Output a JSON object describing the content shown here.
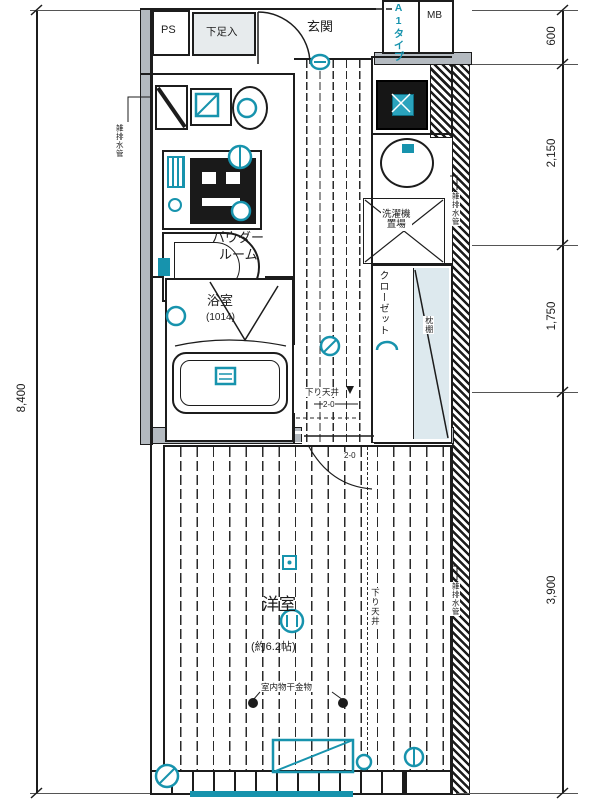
{
  "plan_type": "A1タイプ",
  "labels": {
    "ps": "PS",
    "mb": "MB",
    "shoe_cabinet": "下足入",
    "entrance": "玄関",
    "powder_room_line1": "パウダー",
    "powder_room_line2": "ルーム",
    "bathroom": "浴室",
    "bathroom_size": "(1014)",
    "washer_line1": "洗濯機",
    "washer_line2": "置場",
    "closet": "クローゼット",
    "closet_shelf": "枕棚",
    "western_room": "洋室",
    "western_room_size": "(約6.2帖)",
    "indoor_laundry_hook": "室内物干金物",
    "lowered_ceiling_hall": "下り天井",
    "ceiling_marker_hall": "2-0",
    "ceiling_marker_room": "2-0",
    "lowered_ceiling_room": "下り天井",
    "pipe_left": "雑排水管",
    "pipe_right_top": "雑排水管",
    "pipe_right_bottom": "雑排水管"
  },
  "dimensions": {
    "overall": "8,400",
    "top": "600",
    "upper": "2,150",
    "middle": "1,750",
    "lower": "3,900"
  },
  "colors": {
    "accent": "#1793ad",
    "wall_fill": "#b4bac0",
    "line": "#1c1c1c"
  }
}
